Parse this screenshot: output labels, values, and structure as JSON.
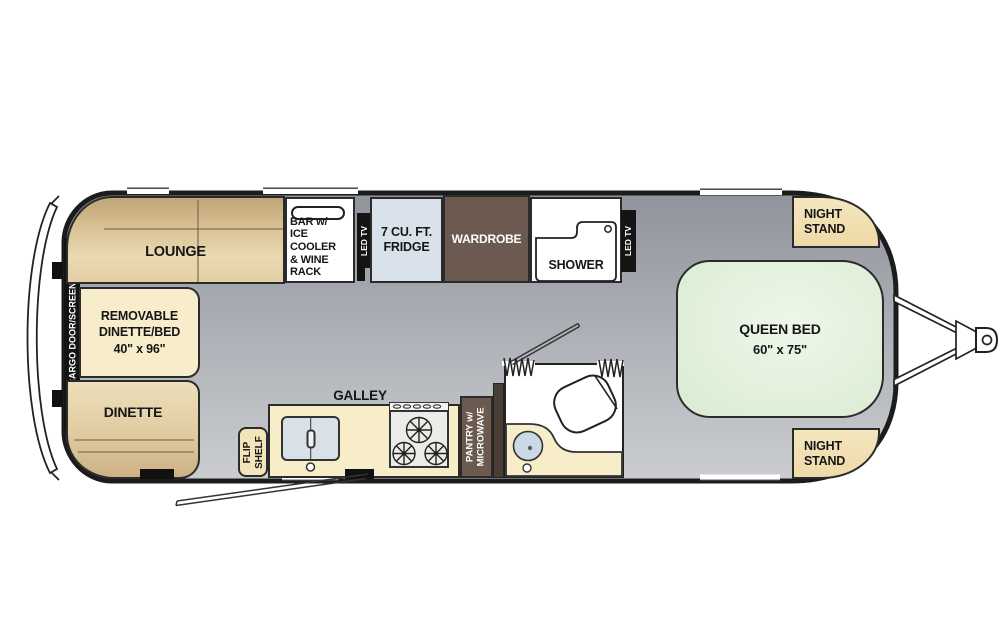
{
  "floorplan": {
    "cargo_door": {
      "label": "CARGO DOOR/SCREEN"
    },
    "lounge": {
      "label": "LOUNGE"
    },
    "removable_dinette": {
      "line1": "REMOVABLE",
      "line2": "DINETTE/BED",
      "dims": "40\" x 96\""
    },
    "dinette": {
      "label": "DINETTE"
    },
    "bar": {
      "line1": "BAR w/",
      "line2": "ICE COOLER",
      "line3": "& WINE RACK"
    },
    "led_tv": {
      "label": "LED TV"
    },
    "fridge": {
      "line1": "7 CU. FT.",
      "line2": "FRIDGE"
    },
    "wardrobe": {
      "label": "WARDROBE"
    },
    "shower": {
      "label": "SHOWER"
    },
    "night_stand": {
      "line1": "NIGHT",
      "line2": "STAND"
    },
    "queen_bed": {
      "label": "QUEEN BED",
      "dims": "60\" x 75\""
    },
    "galley": {
      "label": "GALLEY"
    },
    "flip_shelf": {
      "line1": "FLIP",
      "line2": "SHELF"
    },
    "pantry": {
      "line1": "PANTRY w/",
      "line2": "MICROWAVE"
    },
    "colors": {
      "outline": "#1c1c1c",
      "floor_gray": "#a3a6ad",
      "upholstery_tan": "#dcc59b",
      "cabinet_cream": "#f7edc9",
      "wood_brown": "#6d5b50",
      "appliance_blue": "#dce5ec",
      "bed_green": "#e3f0dd",
      "tv_black": "#141414"
    }
  }
}
